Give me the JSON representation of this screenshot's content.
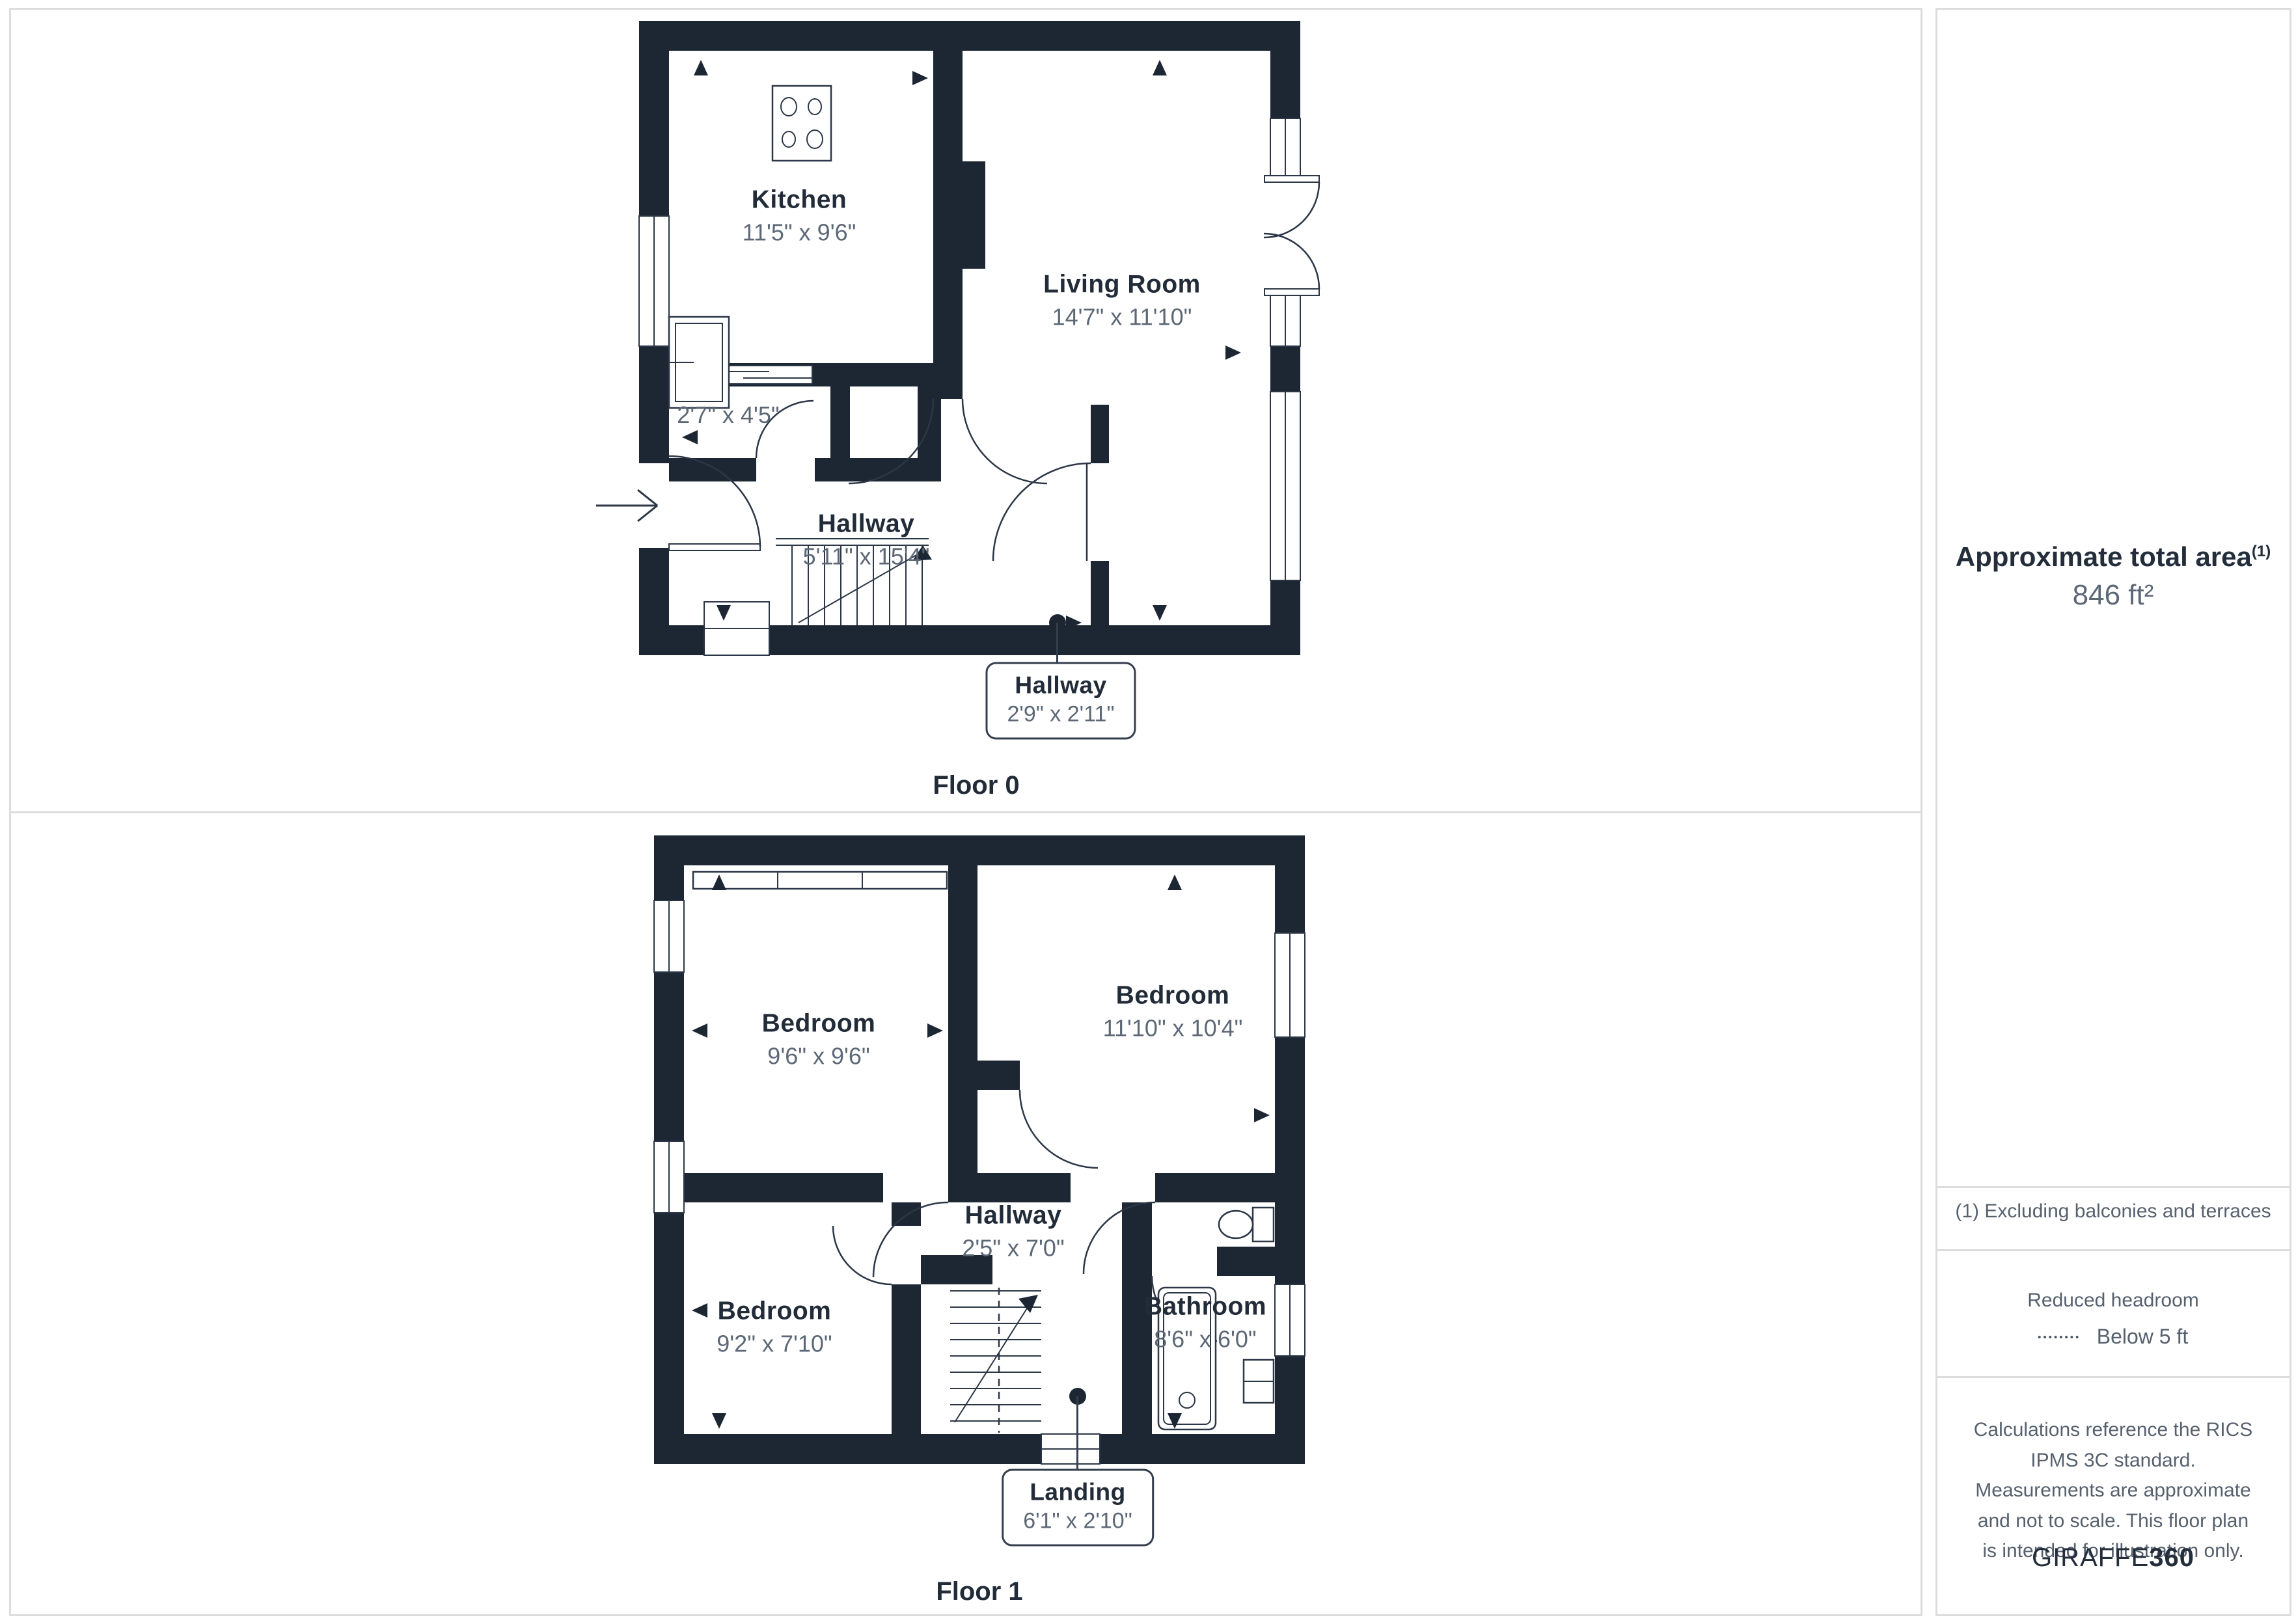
{
  "colors": {
    "wall": "#1d2734",
    "room_name": "#222c39",
    "dims_text": "#5d6877",
    "panel_border": "#dcdcdc",
    "callout_border": "#333e4e",
    "sidebar_text": "#57616e"
  },
  "floor0": {
    "label": "Floor 0",
    "rooms": [
      {
        "name": "Kitchen",
        "dims": "11'5\" x 9'6\""
      },
      {
        "name": "Living Room",
        "dims": "14'7\" x 11'10\""
      },
      {
        "name": "",
        "dims": "2'7\" x 4'5\""
      },
      {
        "name": "Hallway",
        "dims": "5'11\" x 15'4\""
      }
    ],
    "callout": {
      "name": "Hallway",
      "dims": "2'9\" x 2'11\""
    }
  },
  "floor1": {
    "label": "Floor 1",
    "rooms": [
      {
        "name": "Bedroom",
        "dims": "9'6\" x 9'6\""
      },
      {
        "name": "Bedroom",
        "dims": "11'10\" x 10'4\""
      },
      {
        "name": "Hallway",
        "dims": "2'5\" x 7'0\""
      },
      {
        "name": "Bedroom",
        "dims": "9'2\" x 7'10\""
      },
      {
        "name": "Bathroom",
        "dims": "8'6\" x 6'0\""
      }
    ],
    "callout": {
      "name": "Landing",
      "dims": "6'1\" x 2'10\""
    }
  },
  "sidebar": {
    "area_title": "Approximate total area",
    "area_superscript": "(1)",
    "area_value": "846 ft²",
    "footnote": "(1) Excluding balconies and terraces",
    "headroom_title": "Reduced headroom",
    "headroom_value": "Below 5 ft",
    "disclaimer": "Calculations reference the RICS IPMS 3C standard. Measurements are approximate and not to scale. This floor plan is intended for illustration only.",
    "brand_name": "GIRAFFE",
    "brand_number": "360"
  }
}
